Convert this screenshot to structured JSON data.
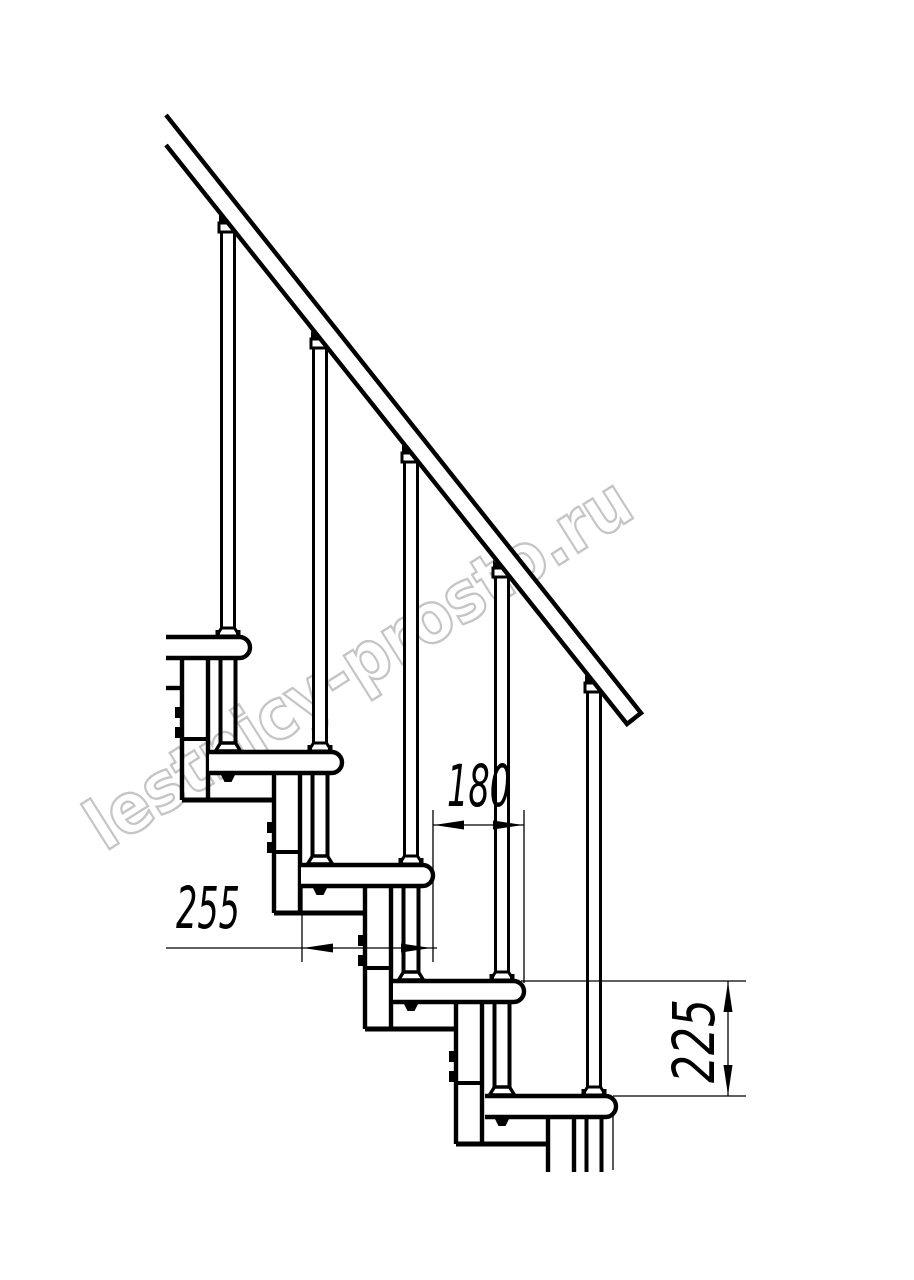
{
  "meta": {
    "width": 914,
    "height": 1280,
    "background": "#ffffff",
    "line_color": "#000000"
  },
  "annotations": {
    "watermark": {
      "text": "lestnicy-prosto.ru",
      "fill": "#ffffff",
      "outline": "#c5c5c5"
    },
    "dim_run": {
      "text": "180",
      "meaning": "step run between tread noses"
    },
    "dim_tread_depth": {
      "text": "255",
      "meaning": "tread depth"
    },
    "dim_rise": {
      "text": "225",
      "meaning": "step rise"
    }
  },
  "shapes": [
    {
      "kind": "text",
      "name": "watermark-text",
      "bind": "watermark",
      "x": 0,
      "y": 0,
      "fs": 70,
      "bold": true,
      "fill": "#ffffff",
      "stroke": "#c5c5c5",
      "sw": 2.4,
      "textLength": 630,
      "transform": "translate(105,852) rotate(-32.3)"
    },
    {
      "kind": "line",
      "name": "module-0-baseplate-line",
      "x1": 166,
      "y1": 688,
      "x2": 182,
      "y2": 688,
      "w": 4.4
    },
    {
      "kind": "line",
      "name": "column-1-left-line",
      "x1": 182,
      "y1": 655,
      "x2": 182,
      "y2": 800,
      "w": 4.4
    },
    {
      "kind": "line",
      "name": "column-1-right-line",
      "x1": 208,
      "y1": 655,
      "x2": 208,
      "y2": 800,
      "w": 4.4
    },
    {
      "kind": "line",
      "name": "column-1-joint-line",
      "x1": 182,
      "y1": 739,
      "x2": 208,
      "y2": 739,
      "w": 4
    },
    {
      "kind": "line",
      "name": "column-1-baseplate-line",
      "x1": 182,
      "y1": 800,
      "x2": 274,
      "y2": 800,
      "w": 5
    },
    {
      "kind": "rect",
      "name": "column-1-bolt",
      "x": 175,
      "y": 707,
      "w": 7,
      "h": 11,
      "fill": "#000"
    },
    {
      "kind": "rect",
      "name": "column-1-bolt",
      "x": 175,
      "y": 727,
      "w": 7,
      "h": 11,
      "fill": "#000"
    },
    {
      "kind": "line",
      "name": "column-2-left-line",
      "x1": 274,
      "y1": 770,
      "x2": 274,
      "y2": 913,
      "w": 4.4
    },
    {
      "kind": "line",
      "name": "column-2-right-line",
      "x1": 300,
      "y1": 770,
      "x2": 300,
      "y2": 913,
      "w": 4.4
    },
    {
      "kind": "line",
      "name": "column-2-joint-line",
      "x1": 274,
      "y1": 852,
      "x2": 300,
      "y2": 852,
      "w": 4
    },
    {
      "kind": "line",
      "name": "column-2-baseplate-line",
      "x1": 274,
      "y1": 913,
      "x2": 365,
      "y2": 913,
      "w": 5
    },
    {
      "kind": "rect",
      "name": "column-2-bolt",
      "x": 267,
      "y": 822,
      "w": 7,
      "h": 11,
      "fill": "#000"
    },
    {
      "kind": "rect",
      "name": "column-2-bolt",
      "x": 267,
      "y": 842,
      "w": 7,
      "h": 11,
      "fill": "#000"
    },
    {
      "kind": "line",
      "name": "column-3-left-line",
      "x1": 365,
      "y1": 883,
      "x2": 365,
      "y2": 1029,
      "w": 4.4
    },
    {
      "kind": "line",
      "name": "column-3-right-line",
      "x1": 391,
      "y1": 883,
      "x2": 391,
      "y2": 1029,
      "w": 4.4
    },
    {
      "kind": "line",
      "name": "column-3-joint-line",
      "x1": 365,
      "y1": 968,
      "x2": 391,
      "y2": 968,
      "w": 4
    },
    {
      "kind": "line",
      "name": "column-3-baseplate-line",
      "x1": 365,
      "y1": 1029,
      "x2": 456,
      "y2": 1029,
      "w": 5
    },
    {
      "kind": "rect",
      "name": "column-3-bolt",
      "x": 358,
      "y": 935,
      "w": 7,
      "h": 11,
      "fill": "#000"
    },
    {
      "kind": "rect",
      "name": "column-3-bolt",
      "x": 358,
      "y": 955,
      "w": 7,
      "h": 11,
      "fill": "#000"
    },
    {
      "kind": "line",
      "name": "column-4-left-line",
      "x1": 456,
      "y1": 999,
      "x2": 456,
      "y2": 1144,
      "w": 4.4
    },
    {
      "kind": "line",
      "name": "column-4-right-line",
      "x1": 482,
      "y1": 999,
      "x2": 482,
      "y2": 1144,
      "w": 4.4
    },
    {
      "kind": "line",
      "name": "column-4-joint-line",
      "x1": 456,
      "y1": 1083,
      "x2": 482,
      "y2": 1083,
      "w": 4
    },
    {
      "kind": "line",
      "name": "column-4-baseplate-line",
      "x1": 456,
      "y1": 1144,
      "x2": 548,
      "y2": 1144,
      "w": 5
    },
    {
      "kind": "rect",
      "name": "column-4-bolt",
      "x": 449,
      "y": 1051,
      "w": 7,
      "h": 11,
      "fill": "#000"
    },
    {
      "kind": "rect",
      "name": "column-4-bolt",
      "x": 449,
      "y": 1071,
      "w": 7,
      "h": 11,
      "fill": "#000"
    },
    {
      "kind": "line",
      "name": "column-5-left-line",
      "x1": 548,
      "y1": 1114,
      "x2": 548,
      "y2": 1172,
      "w": 4.4
    },
    {
      "kind": "line",
      "name": "column-5-right-line",
      "x1": 574,
      "y1": 1114,
      "x2": 574,
      "y2": 1172,
      "w": 4.4
    },
    {
      "kind": "line",
      "name": "support-pipe-1-left",
      "x1": 220.5,
      "y1": 658,
      "x2": 220.5,
      "y2": 743,
      "w": 4
    },
    {
      "kind": "line",
      "name": "support-pipe-1-right",
      "x1": 235.5,
      "y1": 658,
      "x2": 235.5,
      "y2": 743,
      "w": 4
    },
    {
      "kind": "poly",
      "name": "support-pipe-1-base",
      "pts": "220.5,743 235.5,743 240.5,751 215.5,751",
      "fill": "#fff",
      "sw": 3.4
    },
    {
      "kind": "line",
      "name": "support-pipe-2-left",
      "x1": 312.5,
      "y1": 773,
      "x2": 312.5,
      "y2": 856,
      "w": 4
    },
    {
      "kind": "line",
      "name": "support-pipe-2-right",
      "x1": 327.5,
      "y1": 773,
      "x2": 327.5,
      "y2": 856,
      "w": 4
    },
    {
      "kind": "poly",
      "name": "support-pipe-2-base",
      "pts": "312.5,856 327.5,856 332.5,864 307.5,864",
      "fill": "#fff",
      "sw": 3.4
    },
    {
      "kind": "line",
      "name": "support-pipe-3-left",
      "x1": 403.5,
      "y1": 886,
      "x2": 403.5,
      "y2": 972,
      "w": 4
    },
    {
      "kind": "line",
      "name": "support-pipe-3-right",
      "x1": 418.5,
      "y1": 886,
      "x2": 418.5,
      "y2": 972,
      "w": 4
    },
    {
      "kind": "poly",
      "name": "support-pipe-3-base",
      "pts": "403.5,972 418.5,972 423.5,980 398.5,980",
      "fill": "#fff",
      "sw": 3.4
    },
    {
      "kind": "line",
      "name": "support-pipe-4-left",
      "x1": 494.5,
      "y1": 1002,
      "x2": 494.5,
      "y2": 1087,
      "w": 4
    },
    {
      "kind": "line",
      "name": "support-pipe-4-right",
      "x1": 509.5,
      "y1": 1002,
      "x2": 509.5,
      "y2": 1087,
      "w": 4
    },
    {
      "kind": "poly",
      "name": "support-pipe-4-base",
      "pts": "494.5,1087 509.5,1087 514.5,1095 489.5,1095",
      "fill": "#fff",
      "sw": 3.4
    },
    {
      "kind": "line",
      "name": "support-pipe-5-left",
      "x1": 586.5,
      "y1": 1117,
      "x2": 586.5,
      "y2": 1172,
      "w": 4
    },
    {
      "kind": "line",
      "name": "support-pipe-5-right",
      "x1": 601.5,
      "y1": 1117,
      "x2": 601.5,
      "y2": 1172,
      "w": 4
    },
    {
      "kind": "path",
      "name": "tread-1",
      "d": "M166,637 H239.5 A10.5,10.5 0 0 1 239.5,658 H166",
      "fill": "#fff",
      "sw": 4.4
    },
    {
      "kind": "path",
      "name": "tread-2",
      "d": "M209,752 H331.5 A10.5,10.5 0 0 1 331.5,773 H209",
      "fill": "#fff",
      "sw": 4.4
    },
    {
      "kind": "path",
      "name": "tread-3",
      "d": "M301,865 H422.5 A10.5,10.5 0 0 1 422.5,886 H301",
      "fill": "#fff",
      "sw": 4.4
    },
    {
      "kind": "path",
      "name": "tread-4",
      "d": "M393,981 H513.5 A10.5,10.5 0 0 1 513.5,1002 H393",
      "fill": "#fff",
      "sw": 4.4
    },
    {
      "kind": "path",
      "name": "tread-5",
      "d": "M485,1096 H605.5 A10.5,10.5 0 0 1 605.5,1117 H485",
      "fill": "#fff",
      "sw": 4.4
    },
    {
      "kind": "poly",
      "name": "tread-2-nut",
      "pts": "220,773 236,773 231.5,782 224.5,782",
      "fill": "#000"
    },
    {
      "kind": "poly",
      "name": "tread-3-nut",
      "pts": "312,886 328,886 323.5,895 316.5,895",
      "fill": "#000"
    },
    {
      "kind": "poly",
      "name": "tread-4-nut",
      "pts": "403,1002 419,1002 414.5,1011 407.5,1011",
      "fill": "#000"
    },
    {
      "kind": "poly",
      "name": "tread-5-nut",
      "pts": "494,1117 510,1117 505.5,1126 498.5,1126",
      "fill": "#000"
    },
    {
      "kind": "poly",
      "name": "baluster-1-rail-wedge",
      "pts": "219,225 229,225 219,215",
      "fill": "#000"
    },
    {
      "kind": "rect",
      "name": "baluster-1-cap",
      "x": 219,
      "y": 223,
      "w": 18,
      "h": 9,
      "fill": "#fff",
      "sw": 3
    },
    {
      "kind": "rect",
      "name": "baluster-1-tube",
      "x": 221.5,
      "y": 232,
      "w": 13,
      "h": 396,
      "fill": "#fff",
      "sw": 3
    },
    {
      "kind": "poly",
      "name": "baluster-1-base",
      "pts": "221.5,628 234.5,628 239.5,636 216.5,636",
      "fill": "#fff",
      "sw": 3
    },
    {
      "kind": "rect",
      "name": "baluster-1-base-nub",
      "x": 215.5,
      "y": 630,
      "w": 4.5,
      "h": 6,
      "fill": "#000"
    },
    {
      "kind": "rect",
      "name": "baluster-1-base-nub",
      "x": 236,
      "y": 630,
      "w": 4.5,
      "h": 6,
      "fill": "#000"
    },
    {
      "kind": "poly",
      "name": "baluster-2-rail-wedge",
      "pts": "311,341 321,341 311,331",
      "fill": "#000"
    },
    {
      "kind": "rect",
      "name": "baluster-2-cap",
      "x": 311,
      "y": 339,
      "w": 18,
      "h": 9,
      "fill": "#fff",
      "sw": 3
    },
    {
      "kind": "rect",
      "name": "baluster-2-tube",
      "x": 313.5,
      "y": 348,
      "w": 13,
      "h": 395,
      "fill": "#fff",
      "sw": 3
    },
    {
      "kind": "poly",
      "name": "baluster-2-base",
      "pts": "313.5,743 326.5,743 331.5,751 308.5,751",
      "fill": "#fff",
      "sw": 3
    },
    {
      "kind": "rect",
      "name": "baluster-2-base-nub",
      "x": 307.5,
      "y": 745,
      "w": 4.5,
      "h": 6,
      "fill": "#000"
    },
    {
      "kind": "rect",
      "name": "baluster-2-base-nub",
      "x": 328,
      "y": 745,
      "w": 4.5,
      "h": 6,
      "fill": "#000"
    },
    {
      "kind": "poly",
      "name": "baluster-3-rail-wedge",
      "pts": "402,455 412,455 402,445",
      "fill": "#000"
    },
    {
      "kind": "rect",
      "name": "baluster-3-cap",
      "x": 402,
      "y": 453,
      "w": 18,
      "h": 9,
      "fill": "#fff",
      "sw": 3
    },
    {
      "kind": "rect",
      "name": "baluster-3-tube",
      "x": 404.5,
      "y": 462,
      "w": 13,
      "h": 394,
      "fill": "#fff",
      "sw": 3
    },
    {
      "kind": "poly",
      "name": "baluster-3-base",
      "pts": "404.5,856 417.5,856 422.5,864 399.5,864",
      "fill": "#fff",
      "sw": 3
    },
    {
      "kind": "rect",
      "name": "baluster-3-base-nub",
      "x": 398.5,
      "y": 858,
      "w": 4.5,
      "h": 6,
      "fill": "#000"
    },
    {
      "kind": "rect",
      "name": "baluster-3-base-nub",
      "x": 419,
      "y": 858,
      "w": 4.5,
      "h": 6,
      "fill": "#000"
    },
    {
      "kind": "poly",
      "name": "baluster-4-rail-wedge",
      "pts": "493,570 503,570 493,560",
      "fill": "#000"
    },
    {
      "kind": "rect",
      "name": "baluster-4-cap",
      "x": 493,
      "y": 568,
      "w": 18,
      "h": 9,
      "fill": "#fff",
      "sw": 3
    },
    {
      "kind": "rect",
      "name": "baluster-4-tube",
      "x": 495.5,
      "y": 577,
      "w": 13,
      "h": 395,
      "fill": "#fff",
      "sw": 3
    },
    {
      "kind": "poly",
      "name": "baluster-4-base",
      "pts": "495.5,972 508.5,972 513.5,980 490.5,980",
      "fill": "#fff",
      "sw": 3
    },
    {
      "kind": "rect",
      "name": "baluster-4-base-nub",
      "x": 489.5,
      "y": 974,
      "w": 4.5,
      "h": 6,
      "fill": "#000"
    },
    {
      "kind": "rect",
      "name": "baluster-4-base-nub",
      "x": 510,
      "y": 974,
      "w": 4.5,
      "h": 6,
      "fill": "#000"
    },
    {
      "kind": "poly",
      "name": "baluster-5-rail-wedge",
      "pts": "585,685 595,685 585,675",
      "fill": "#000"
    },
    {
      "kind": "rect",
      "name": "baluster-5-cap",
      "x": 585,
      "y": 683,
      "w": 18,
      "h": 9,
      "fill": "#fff",
      "sw": 3
    },
    {
      "kind": "rect",
      "name": "baluster-5-tube",
      "x": 587.5,
      "y": 692,
      "w": 13,
      "h": 395,
      "fill": "#fff",
      "sw": 3
    },
    {
      "kind": "poly",
      "name": "baluster-5-base",
      "pts": "587.5,1087 600.5,1087 605.5,1095 582.5,1095",
      "fill": "#fff",
      "sw": 3
    },
    {
      "kind": "rect",
      "name": "baluster-5-base-nub",
      "x": 581.5,
      "y": 1089,
      "w": 4.5,
      "h": 6,
      "fill": "#000"
    },
    {
      "kind": "rect",
      "name": "baluster-5-base-nub",
      "x": 602,
      "y": 1089,
      "w": 4.5,
      "h": 6,
      "fill": "#000"
    },
    {
      "kind": "path",
      "name": "handrail",
      "d": "M166,115 L641,713 L627,724 L166,145",
      "fill": "#fff",
      "sw": 4.4
    },
    {
      "kind": "line",
      "name": "extension-line",
      "x1": 302,
      "y1": 887,
      "x2": 302,
      "y2": 962,
      "w": 1.3
    },
    {
      "kind": "line",
      "name": "extension-line",
      "x1": 433,
      "y1": 810,
      "x2": 433,
      "y2": 962,
      "w": 1.3
    },
    {
      "kind": "line",
      "name": "extension-line",
      "x1": 524,
      "y1": 810,
      "x2": 524,
      "y2": 983,
      "w": 1.3
    },
    {
      "kind": "line",
      "name": "extension-line",
      "x1": 521,
      "y1": 981,
      "x2": 746,
      "y2": 981,
      "w": 1.3
    },
    {
      "kind": "line",
      "name": "extension-line",
      "x1": 613,
      "y1": 1096,
      "x2": 746,
      "y2": 1096,
      "w": 1.3
    },
    {
      "kind": "line",
      "name": "extension-line",
      "x1": 613,
      "y1": 1113,
      "x2": 613,
      "y2": 1170,
      "w": 1.3
    },
    {
      "kind": "line",
      "name": "dim-line-255",
      "x1": 166,
      "y1": 948,
      "x2": 437,
      "y2": 948,
      "w": 1.3
    },
    {
      "kind": "poly",
      "name": "dim-arrow-left",
      "pts": "303,948 333,943.5 333,952.5",
      "fill": "#000"
    },
    {
      "kind": "poly",
      "name": "dim-arrow-right",
      "pts": "431,948 401,943.5 401,952.5",
      "fill": "#000"
    },
    {
      "kind": "text",
      "name": "dim-label-255",
      "bind": "dim_tread_depth",
      "x": 176,
      "y": 928,
      "fs": 58,
      "italic": true,
      "fill": "#000",
      "textLength": 64
    },
    {
      "kind": "line",
      "name": "dim-line-180",
      "x1": 433,
      "y1": 825,
      "x2": 524,
      "y2": 825,
      "w": 1.3
    },
    {
      "kind": "poly",
      "name": "dim-arrow-left",
      "pts": "434,825 464,820.5 464,829.5",
      "fill": "#000"
    },
    {
      "kind": "poly",
      "name": "dim-arrow-right",
      "pts": "523,825 493,820.5 493,829.5",
      "fill": "#000"
    },
    {
      "kind": "text",
      "name": "dim-label-180",
      "bind": "dim_run",
      "x": 447,
      "y": 806,
      "fs": 58,
      "italic": true,
      "fill": "#000",
      "textLength": 64
    },
    {
      "kind": "line",
      "name": "dim-line-225",
      "x1": 728,
      "y1": 981,
      "x2": 728,
      "y2": 1096,
      "w": 1.3
    },
    {
      "kind": "poly",
      "name": "dim-arrow-up",
      "pts": "728,982 723.5,1012 732.5,1012",
      "fill": "#000"
    },
    {
      "kind": "poly",
      "name": "dim-arrow-down",
      "pts": "728,1095 723.5,1065 732.5,1065",
      "fill": "#000"
    },
    {
      "kind": "text",
      "name": "dim-label-225",
      "bind": "dim_rise",
      "x": 0,
      "y": 0,
      "fs": 58,
      "italic": true,
      "fill": "#000",
      "textLength": 84,
      "transform": "translate(714,1083) rotate(-90)"
    }
  ]
}
